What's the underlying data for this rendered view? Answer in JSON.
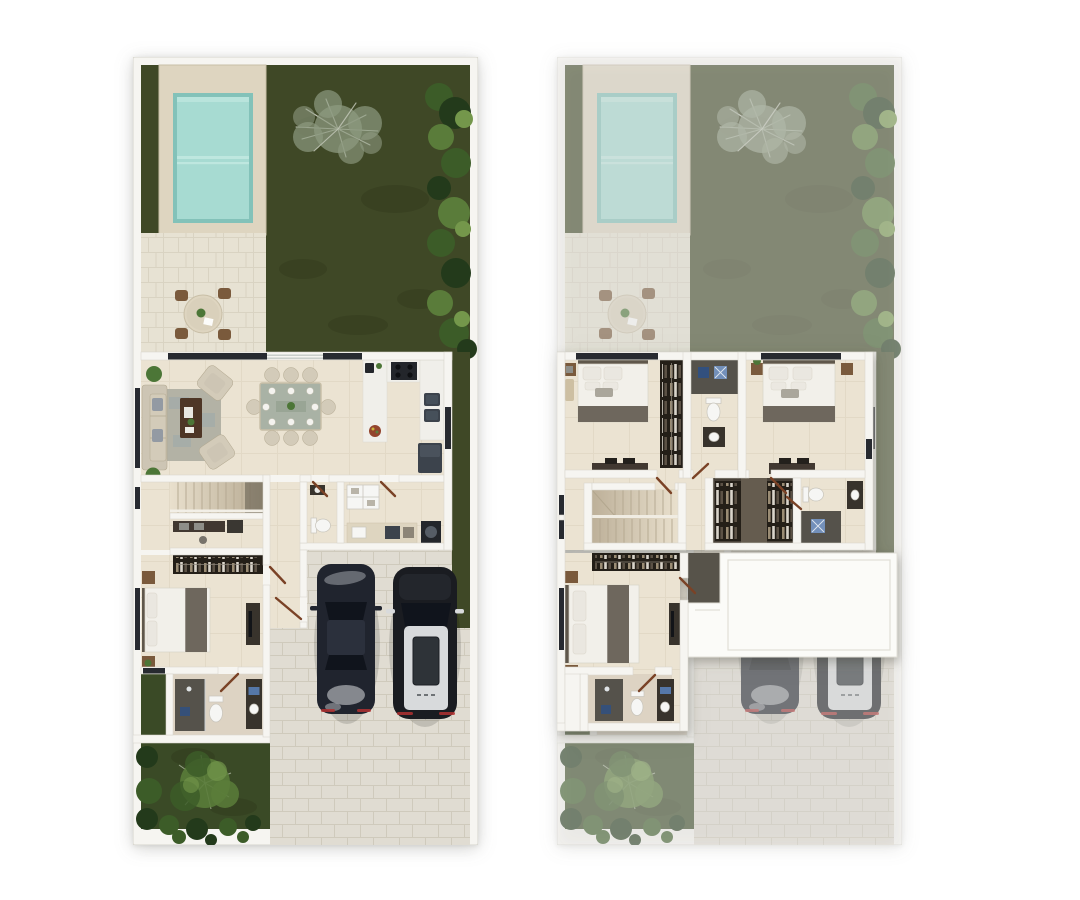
{
  "meta": {
    "description": "Top-down 3D render of a two-storey townhouse: ground floor plan (left) and upper floor plan drawn over a faded ground floor (right)",
    "canvas": {
      "width": 1080,
      "height": 900
    },
    "background": "#ffffff"
  },
  "palette": {
    "wall": "#f6f5f1",
    "wall-edge": "#d7d5cd",
    "win": "#272a30",
    "glass": "#c4cac6",
    "grass": "#3f4826",
    "grass-dark": "#2b3317",
    "grass-front": "#3a4a26",
    "bush1": "#233a1b",
    "bush2": "#3c5c28",
    "bush3": "#5a7c3a",
    "bush4": "#74974b",
    "tree-sage": "#8d9a80",
    "tree-branch": "#c7cbbd",
    "plant": "#4c7637",
    "deck": "#ded5c0",
    "deck-edge": "#c8bea6",
    "pool-rim": "#83c2b9",
    "pool": "#a7dbd2",
    "pool-light": "#c4eae2",
    "patio": "#e7e2d3",
    "patio-line": "#d4cebb",
    "floor": "#ebe3d2",
    "floor-line": "#dbd1bb",
    "paver": "#e0dcd2",
    "paver-line": "#cdc7b9",
    "bath-floor": "#ddd3c3",
    "roof": "#fbfbf8",
    "roof-edge": "#e1dfd7",
    "void": "#57534a",
    "sofa": "#cdc5b4",
    "sofa-dark": "#b2a890",
    "chair": "#d3cbb9",
    "pillow-gray": "#939aa3",
    "rug": "#b3b2a5",
    "rug-accent": "#9aa7ab",
    "wood-dark": "#4e3626",
    "wood-mid": "#7a5a3c",
    "door-wood": "#7a4226",
    "table-glass": "#a9b2a5",
    "counter": "#f0efea",
    "appliance": "#23262b",
    "appliance-mid": "#3c434c",
    "steel": "#46505a",
    "closet-dark": "#241f18",
    "closet-floor": "#484138",
    "closet-aisle": "#655c4f",
    "cloth1": "#9a8c74",
    "cloth2": "#d9d4ca",
    "cloth3": "#5c5246",
    "bed-white": "#f2f0ea",
    "bed-stroke": "#d8d3c6",
    "pillow": "#eae7e0",
    "throw": "#6e675d",
    "headboard": "#5f574b",
    "fixture-white": "#f6f6f4",
    "fixture-stroke": "#c8c5bc",
    "dark-fixture": "#38332c",
    "shower-dark": "#55524b",
    "mat-blue": "#32507e",
    "mat-blue-light": "#7390ba",
    "towel-blue": "#5577a8",
    "car1": "#20242e",
    "car1-roof": "#2b303c",
    "car-glass": "#10141c",
    "car2": "#1a1c21",
    "car2-roof": "#d8dadc",
    "highlight": "#e9ebed",
    "taillight": "#b03030",
    "stair-line": "#b3a78f",
    "desk-dark": "#413831",
    "tv": "#121418"
  },
  "plans": {
    "left": {
      "name": "ground-floor-plan",
      "x": 133,
      "y": 57,
      "width": 345,
      "height": 788,
      "features": [
        "backyard-garden",
        "swimming-pool",
        "pool-deck",
        "outdoor-dining-set",
        "backyard-tree",
        "hedge-border",
        "living-room",
        "dining-room",
        "kitchen",
        "staircase",
        "study-nook",
        "wardrobe",
        "bedroom",
        "bathroom",
        "powder-room",
        "laundry",
        "two-car-garage",
        "paved-driveway",
        "front-garden",
        "front-tree"
      ],
      "counts": {
        "cars": 2,
        "dining-chairs": 8,
        "patio-chairs": 4,
        "beds": 1
      }
    },
    "right": {
      "name": "upper-floor-plan",
      "x": 557,
      "y": 57,
      "width": 345,
      "height": 788,
      "underlay": {
        "name": "faded-ground-floor",
        "opacity": 0.56
      },
      "features": [
        "bedroom-1",
        "wardrobe-1",
        "shared-bathroom",
        "bedroom-2",
        "staircase",
        "walk-in-closet",
        "bathroom-2",
        "master-bedroom",
        "master-closet",
        "master-bathroom",
        "roof-slab-over-garage",
        "double-height-void"
      ],
      "counts": {
        "beds": 3,
        "bathrooms": 3,
        "closets": 4
      }
    }
  }
}
